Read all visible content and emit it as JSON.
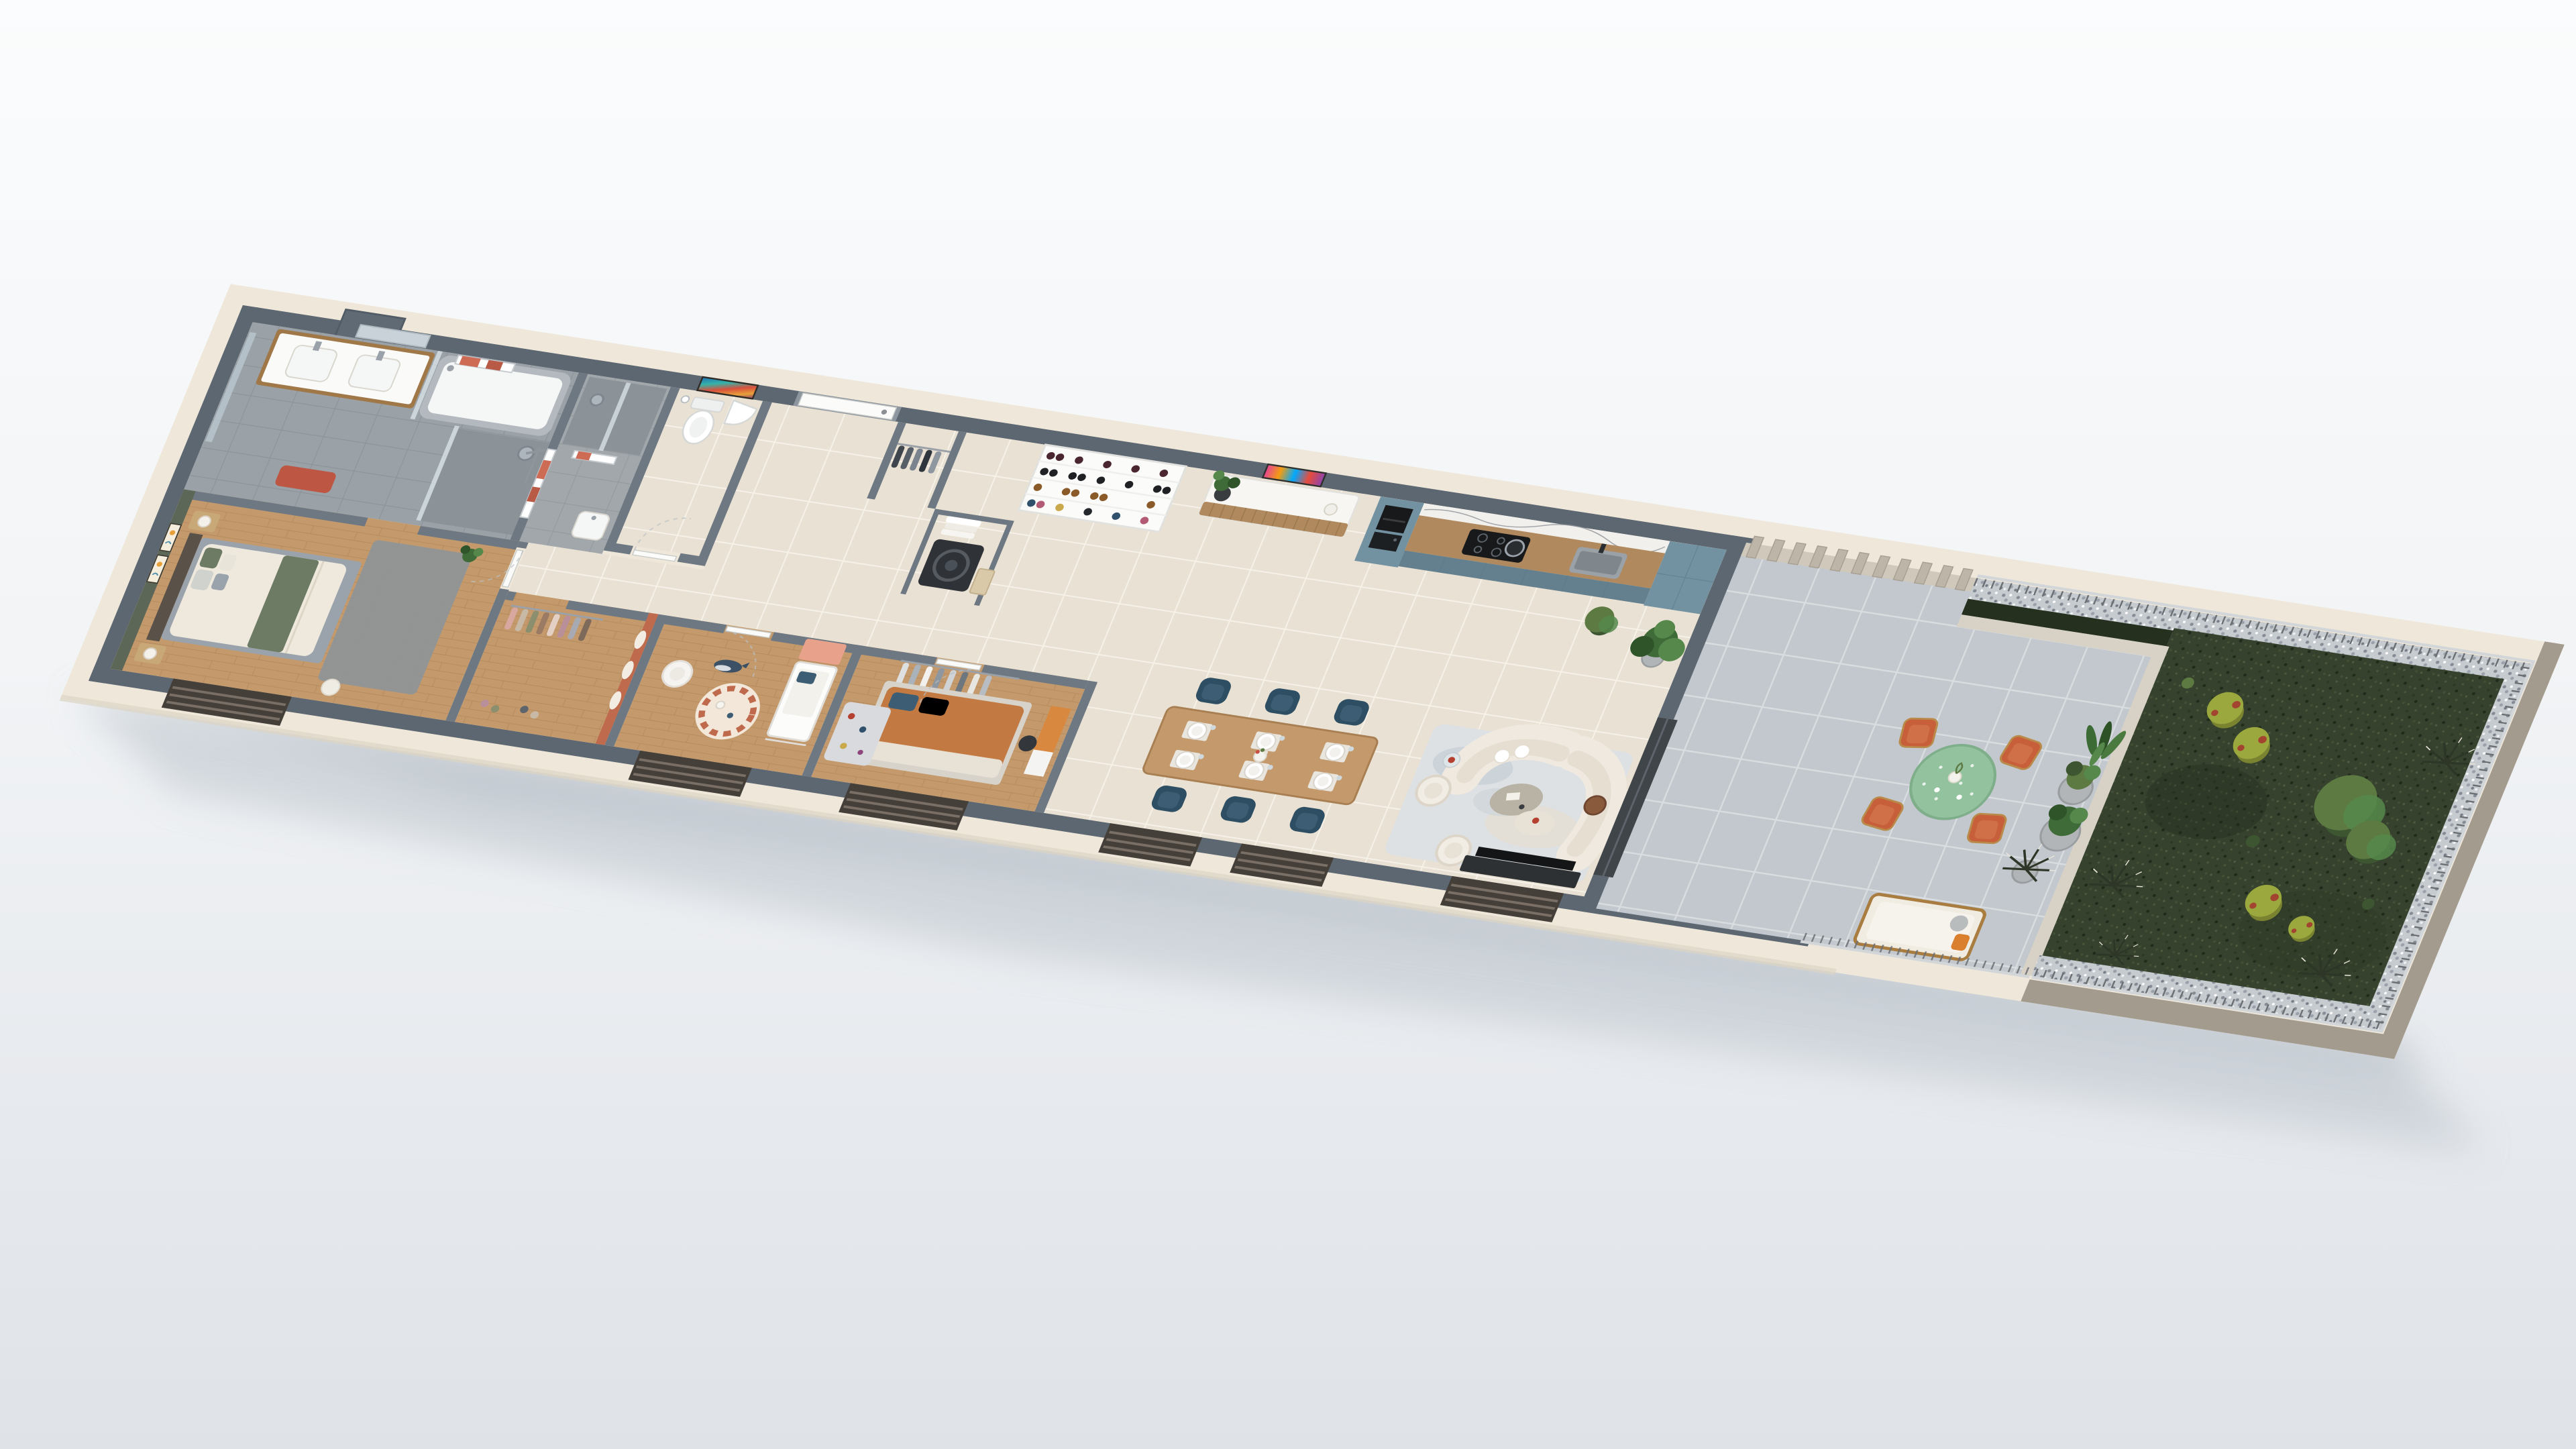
{
  "scene": {
    "kind": "3d-floorplan-render",
    "label": "Isometric 3D cutaway floor plan of a long single-storey apartment with roof terrace and private planted garden",
    "camera": "high isometric view from the front-left",
    "background": "plain light studio backdrop with soft ground shadow",
    "visible_text": "none"
  },
  "palette": {
    "backdrop_hi": "#fbfcfd",
    "backdrop_lo": "#e2e6ea",
    "shadow": "#bac2ca",
    "plinth": "#efe8da",
    "plinth_shade": "#ddd4c3",
    "slab_face": "#a39b8d",
    "wall_top": "#5d6771",
    "wall_partition": "#6e7882",
    "tile_hall": "#e9e1d3",
    "tile_grout": "#f6f2e9",
    "tile_bath": "#9aa1a7",
    "tile_bath_dark": "#8b9298",
    "tile_terrace": "#c2c8cd",
    "terrace_grout": "#d9dde0",
    "wood_floor": "#c49a6c",
    "wood_plank": "#a87f52",
    "wood_furn": "#a07848",
    "olive_wall": "#5d6758",
    "arch_wall": "#c06a4d",
    "kitchen_blue": "#7392a1",
    "kitchen_blue_dark": "#64808e",
    "kitchen_wood": "#b08a5e",
    "marble": "#f2f0ec",
    "navy_chair": "#2e4f63",
    "navy_chair_seat": "#3c5d73",
    "terracotta": "#c65f3a",
    "terracotta_seat": "#d07048",
    "brass": "#b98a4a",
    "table_green": "#93c29e",
    "sofa_cream": "#efe9df",
    "sofa_shade": "#e2dbcd",
    "rug": "#dde1e4",
    "rug_blue": "#c2ccd3",
    "rug_beige": "#e7ddcd",
    "grass_dark": "#36422e",
    "grass_mid": "#46543a",
    "grass_deep": "#26301f",
    "bush_green": "#5d7a42",
    "bush_dark": "#3d5530",
    "bush_yellow": "#9aa83d",
    "bush_red": "#a34430",
    "gravel": "#c6cbd0",
    "gravel_dark": "#848b94",
    "railing_light": "#d3d6d9",
    "railing_dark": "#6b6f73",
    "claustra": "#bdb5a8",
    "claustra_base": "#cfc8bb",
    "parapet": "#d8d2c6",
    "door_white": "#fbfbfa",
    "window_frame": "#453f3a",
    "window_rail": "#7a6f64",
    "tv_black": "#131517",
    "console_dark": "#2e3134",
    "washer_dark": "#2f3338",
    "coral": "#cd6b55",
    "red_mat": "#c0503c",
    "crib_salmon": "#e8a28c",
    "bed_orange": "#c27a42",
    "plant_green": "#3f6b38",
    "plant_dark": "#2f5429",
    "plant_lite": "#55884a",
    "pot_gray": "#b2b5b7",
    "duvet_cream": "#efe9dd",
    "sage": "#6d7b64",
    "bed_gray": "#9aa3ab",
    "white_fixture": "#f5f6f6",
    "chrome": "#9aa1a8"
  },
  "rooms": [
    {
      "id": "master-bedroom",
      "label": "Master bedroom with olive accent wall, double bed and two framed line-art prints",
      "floor": "oak"
    },
    {
      "id": "main-bathroom",
      "label": "Main bathroom with double vanity, bathtub, walk-in shower, towel radiators and red mat",
      "floor": "grey tile"
    },
    {
      "id": "shower-room",
      "label": "Second shower room with rain shower, basin and towel radiator",
      "floor": "grey tile"
    },
    {
      "id": "wc",
      "label": "Separate WC with toilet and corner hand basin",
      "floor": "tile"
    },
    {
      "id": "entry-hall",
      "label": "Entry hall with white front door, abstract painting, coat closet and laundry nook",
      "floor": "beige tile"
    },
    {
      "id": "pantry",
      "label": "Open pantry shelving stocked with bottles and jars",
      "floor": "beige tile"
    },
    {
      "id": "dressing",
      "label": "Dressing with open hanging rails and arch-motif accent wall",
      "floor": "oak"
    },
    {
      "id": "nursery",
      "label": "Kids bedroom with crib, whale plush, round arch rug and salmon wardrobe",
      "floor": "oak"
    },
    {
      "id": "bedroom-2",
      "label": "Bedroom with rust orange bed, open wardrobe and desk",
      "floor": "oak"
    },
    {
      "id": "kitchen",
      "label": "Kitchen with slate-blue cabinetry, walnut uppers, marble splashback, oven column, hob and sink",
      "floor": "beige tile"
    },
    {
      "id": "dining-area",
      "label": "Dining area with oak table set for six and navy chairs",
      "floor": "beige tile"
    },
    {
      "id": "living-area",
      "label": "Living area with curved cream sofa, boucle armchairs, coffee tables and TV console",
      "floor": "beige tile"
    },
    {
      "id": "terrace",
      "label": "Tiled terrace with green terrazzo table, four terracotta chairs, lounger, planters and slatted screen",
      "floor": "grey tile"
    },
    {
      "id": "garden",
      "label": "Private garden with dense groundcover, shrubs, ornamental grasses, gravel border and metal railing",
      "floor": "grass"
    }
  ],
  "furniture_counts": {
    "dining_chairs": 6,
    "dining_place_settings": 6,
    "terrace_chairs": 4,
    "sofa_segments": 2,
    "armchairs_living": 2,
    "bedrooms": 3,
    "bathrooms": 2,
    "framed_artworks": 4,
    "front_window_openings": 6,
    "claustra_slats": 11,
    "towel_radiators": 3
  },
  "artworks": [
    {
      "id": "line-art-print-1",
      "location": "master bedroom accent wall"
    },
    {
      "id": "line-art-print-2",
      "location": "master bedroom accent wall"
    },
    {
      "id": "abstract-painting",
      "location": "entry wall beside front door"
    },
    {
      "id": "pop-art-face-painting",
      "location": "living wall above sideboard"
    }
  ]
}
